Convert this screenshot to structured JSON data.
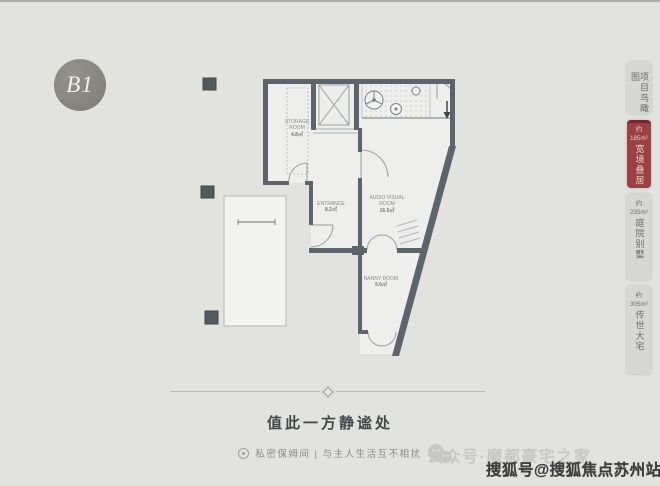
{
  "page": {
    "bg": "#e2e3df",
    "accent": "#9c4044",
    "wall_color": "#5d646c"
  },
  "badge": {
    "label": "B1"
  },
  "sidebar": {
    "tabs": [
      {
        "approx": "",
        "area": "",
        "name": "项目鸟瞰图",
        "active": false
      },
      {
        "approx": "约",
        "area": "185m²",
        "name": "宽境叠居",
        "active": true
      },
      {
        "approx": "约",
        "area": "235m²",
        "name": "庭院别墅",
        "active": false
      },
      {
        "approx": "约",
        "area": "305m²",
        "name": "传世大宅",
        "active": false
      }
    ]
  },
  "plan": {
    "labels": {
      "storage_title": "STORAGE ROOM",
      "storage_area": "4.8㎡",
      "entrance_title": "ENTRANCE",
      "entrance_area": "8.2㎡",
      "theater_title": "AUDIO VISUAL ROOM",
      "theater_area": "16.5㎡",
      "nanny_title": "NANNY ROOM",
      "nanny_area": "9.6㎡"
    }
  },
  "caption": {
    "title": "值此一方静谧处",
    "subtitle": "私密保姆间 | 与主人生活互不相扰"
  },
  "watermarks": {
    "wechat": "公众号·魔都豪宅之家",
    "sohu": "搜狐号@搜狐焦点苏州站"
  }
}
